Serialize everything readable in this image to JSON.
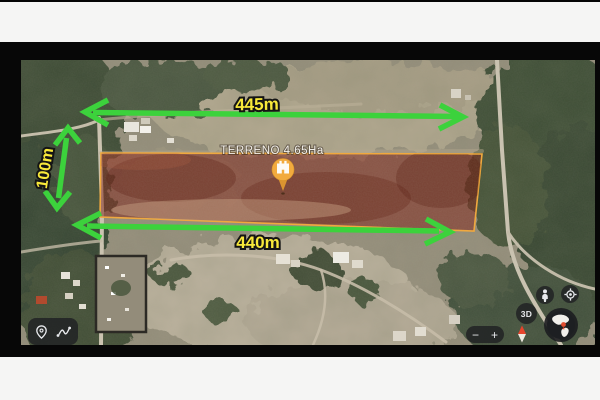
{
  "window": {
    "top_bar_text": "",
    "bottom_bar_text": ""
  },
  "map_overlay": {
    "parcel": {
      "label": "TERRENO 4.65Ha",
      "border_color": "#f2a93c",
      "fill_color": "rgba(125,25,15,0.5)"
    },
    "pin": {
      "icon": "castle-pin-icon",
      "color": "#f2ab3e"
    },
    "measurements": {
      "arrow_color": "#3cd23c",
      "label_color": "#f8e93a",
      "top": {
        "label": "445m"
      },
      "left": {
        "label": "100m"
      },
      "bottom": {
        "label": "440m"
      }
    }
  },
  "controls": {
    "tools": {
      "items": [
        {
          "icon": "location-pin-icon"
        },
        {
          "icon": "measure-path-icon"
        }
      ]
    },
    "street_view": {
      "icon": "pegman-icon"
    },
    "my_location": {
      "icon": "my-location-icon"
    },
    "mode_3d": {
      "label": "3D"
    },
    "globe": {
      "icon": "globe-americas-icon"
    },
    "compass": {
      "icon": "compass-needle-icon"
    },
    "zoom": {
      "out_label": "−",
      "in_label": "+"
    }
  }
}
